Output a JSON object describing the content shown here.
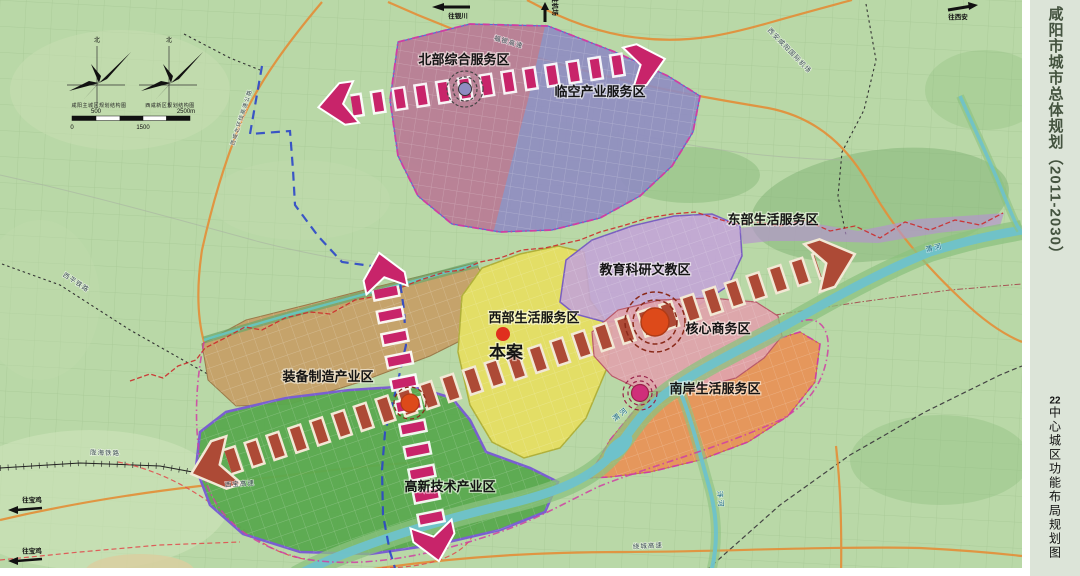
{
  "sidebar": {
    "title": "咸阳市城市总体规划（2011-2030）",
    "subtitle_num": "22",
    "subtitle": "中心城区功能布局规划图"
  },
  "compass": {
    "north": "北",
    "caption_left": "咸阳主城区规划结构图",
    "caption_right": "西咸新区规划结构图"
  },
  "scalebar": {
    "v500": "500",
    "v2500": "2500m",
    "v0": "0",
    "v1500": "1500"
  },
  "zones": [
    {
      "id": "north",
      "label": "北部综合服务区",
      "color": "#bb8193"
    },
    {
      "id": "airport",
      "label": "临空产业服务区",
      "color": "#8f8cc2"
    },
    {
      "id": "east",
      "label": "东部生活服务区",
      "color": "#b592cf"
    },
    {
      "id": "edu",
      "label": "教育科研文教区",
      "color": "#c3a3d8"
    },
    {
      "id": "west-living",
      "label": "西部生活服务区",
      "color": "#e3de66"
    },
    {
      "id": "core",
      "label": "核心商务区",
      "color": "#dfa3ab"
    },
    {
      "id": "south-bank",
      "label": "南岸生活服务区",
      "color": "#e5975c"
    },
    {
      "id": "equipment",
      "label": "装备制造产业区",
      "color": "#c5a36b"
    },
    {
      "id": "hightech",
      "label": "高新技术产业区",
      "color": "#58a94e"
    }
  ],
  "markers": {
    "site_label": "本案"
  },
  "waterways": {
    "weihe": "渭河",
    "weihe2": "渭河",
    "fenghe": "沣河"
  },
  "roads": {
    "fuyin": "福银高速",
    "xibao": "西宝高速",
    "raocheng": "绕城高速",
    "longhai": "陇海铁路",
    "xiping": "西平铁路",
    "beihuan": "西咸北环线高速公路",
    "airport_name": "西安咸阳国际机场"
  },
  "directions": {
    "yinchuan": "往银川",
    "jichang": "往机场",
    "xian": "往西安",
    "baoji1": "往宝鸡",
    "baoji2": "往宝鸡"
  },
  "axis_colors": {
    "main_axis": "#ad4a36",
    "north_axis": "#c8246a",
    "vertical_axis": "#c8246a"
  }
}
